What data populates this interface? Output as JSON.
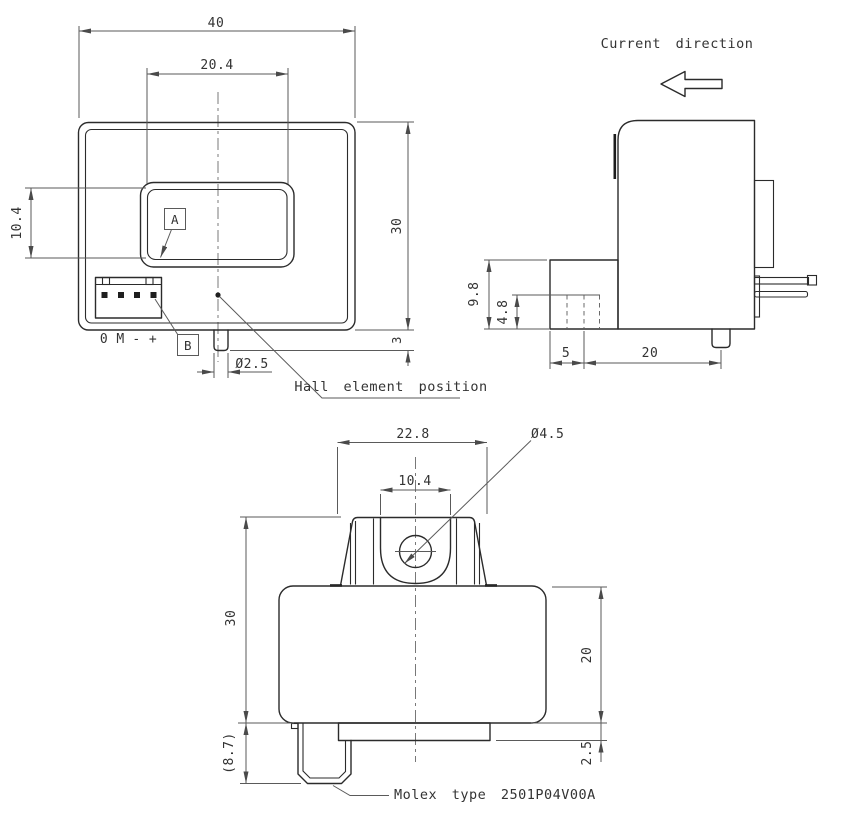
{
  "front": {
    "dim_width": "40",
    "dim_window_width": "20.4",
    "dim_window_height": "10.4",
    "dim_height": "30",
    "dim_peg_height": "3",
    "dim_peg_dia": "Ø2.5",
    "label_a": "A",
    "label_b": "B",
    "pins": [
      "0",
      "M",
      "-",
      "+"
    ],
    "hall_note": "Hall element position"
  },
  "side": {
    "note": "Current direction",
    "dim_conn_height": "9.8",
    "dim_pin_height": "4.8",
    "dim_left": "5",
    "dim_right": "20"
  },
  "bottom": {
    "dim_top_width": "22.8",
    "dim_slot_width": "10.4",
    "dim_hole": "Ø4.5",
    "dim_total_height": "30",
    "dim_body_height": "20",
    "dim_plate": "2.5",
    "dim_conn": "(8.7)",
    "note": "Molex type 2501P04V00A"
  },
  "colors": {
    "object_line": "#2b2b2b",
    "thin_line": "#5a5a5a",
    "background": "#ffffff"
  }
}
